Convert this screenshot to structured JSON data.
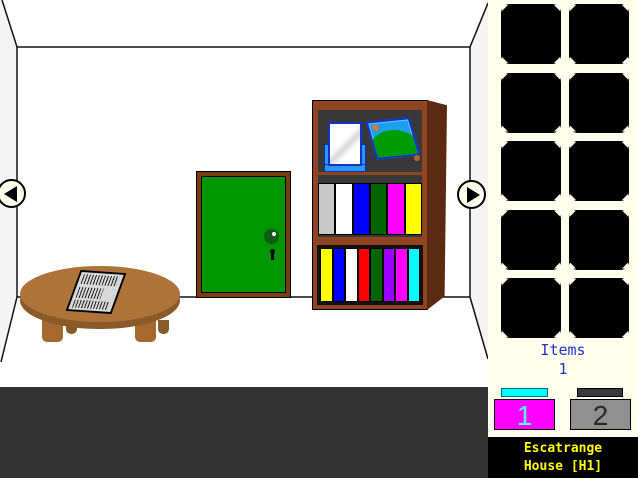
{
  "window": {
    "title": "Escatrange House [H1]",
    "width": 638,
    "height": 478
  },
  "room": {
    "wall_color": "#ffffff",
    "outside_color": "#f4f4f4",
    "floor_band_color": "#333333",
    "door": {
      "name": "green-door",
      "color": "#009600",
      "frame_color": "#7a3d10"
    },
    "bookshelf": {
      "frame_color": "#8f4522",
      "side_color": "#5a2a12",
      "interior_color": "#383838",
      "top_shelf_items": [
        "mirror",
        "picture-frame"
      ],
      "middle_books": [
        "#c8c8c8",
        "#ffffff",
        "#0000ff",
        "#006400",
        "#ff00ff",
        "#ffff00"
      ],
      "bottom_books": [
        "#ffff00",
        "#0000ff",
        "#ffffff",
        "#ff0000",
        "#006400",
        "#9900ff",
        "#ff00ff",
        "#00ffff"
      ]
    },
    "table": {
      "name": "low-round-table",
      "color": "#ad7338",
      "item_on_top": "striped-grate-paper"
    },
    "nav": {
      "left_icon": "left-arrow",
      "right_icon": "right-arrow"
    }
  },
  "sidebar": {
    "background": "#ffffee",
    "slot_count": 10,
    "items_label": "Items",
    "items_count": "1",
    "text_color": "#2233cc",
    "view_buttons": [
      {
        "label": "1",
        "active": true,
        "button_color": "#ff00ff",
        "bar_color": "#00ffff",
        "label_color": "#55ffff"
      },
      {
        "label": "2",
        "active": false,
        "button_color": "#909090",
        "bar_color": "#3a3a3a",
        "label_color": "#2a2a2a"
      }
    ]
  },
  "footer": {
    "line1": "Escatrange",
    "line2": "House [H1]",
    "text_color": "#ffff00",
    "background": "#000000"
  }
}
